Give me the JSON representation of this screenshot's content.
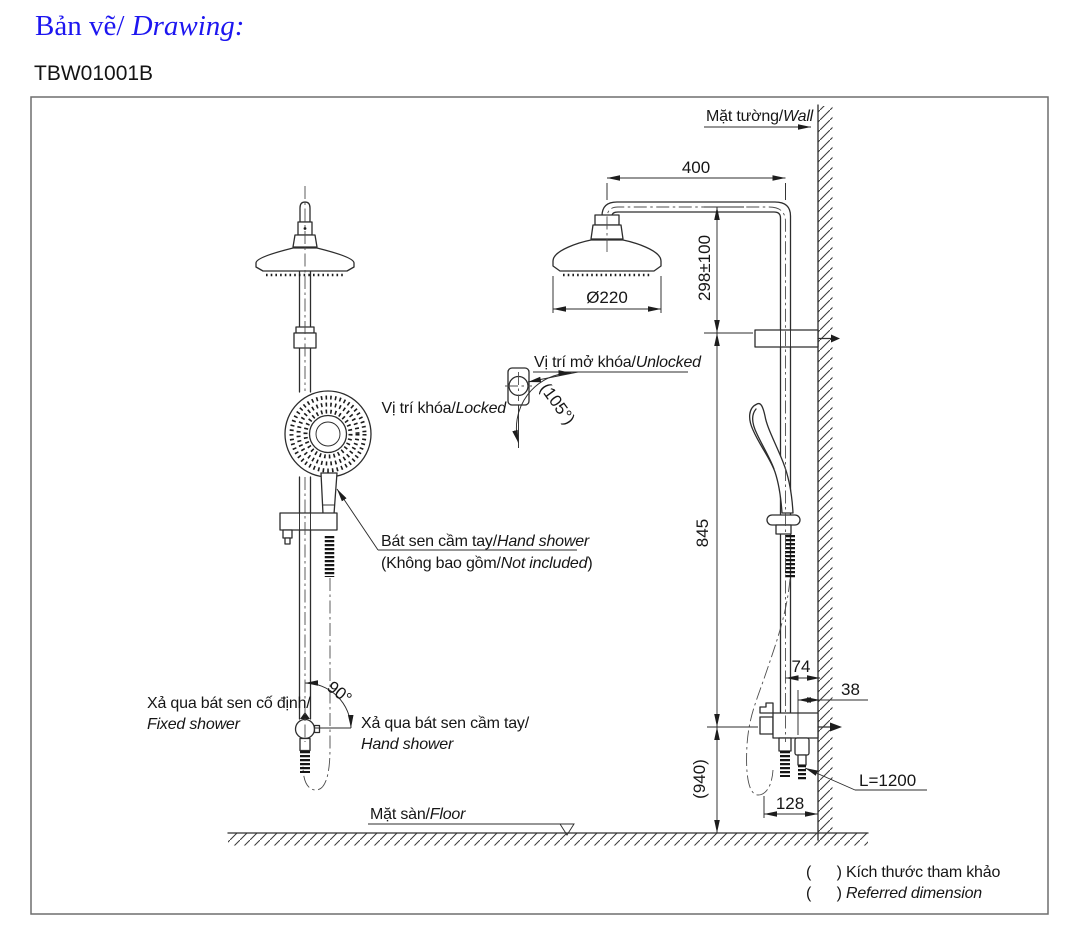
{
  "header": {
    "title_vi": "Bản vẽ/",
    "title_en": "Drawing:",
    "title_color": "#1d16f0",
    "product_code": "TBW01001B"
  },
  "drawing": {
    "wall_label_vi": "Mặt tường/",
    "wall_label_en": "Wall",
    "floor_label_vi": "Mặt sàn/",
    "floor_label_en": "Floor",
    "unlocked_label_vi": "Vị trí mở khóa/",
    "unlocked_label_en": "Unlocked",
    "locked_label_vi": "Vị trí khóa/",
    "locked_label_en": "Locked",
    "hand_shower_label_vi": "Bát sen cầm tay/",
    "hand_shower_label_en": "Hand shower",
    "not_included_vi": "(Không bao gồm/",
    "not_included_en": "Not included",
    "not_included_suffix": ")",
    "fixed_outlet_vi": "Xả qua bát sen cố định/",
    "fixed_outlet_en": "Fixed shower",
    "hand_outlet_vi": "Xả qua bát sen cầm tay/",
    "hand_outlet_en": "Hand shower",
    "dim_arm_reach": "400",
    "dim_head_offset": "298±100",
    "dim_head_diameter": "Ø220",
    "dim_unlock_angle": "(105°)",
    "dim_divert_angle": "90°",
    "dim_slide_bar": "845",
    "dim_wall_to_pipe": "74",
    "dim_wall_to_holder": "38",
    "dim_valve_height": "(940)",
    "dim_valve_width": "128",
    "dim_hose_length": "L=1200",
    "note_ref_vi": "(      ) Kích thước tham khảo",
    "note_ref_en_paren": "(      ) ",
    "note_ref_en": "Referred dimension"
  }
}
